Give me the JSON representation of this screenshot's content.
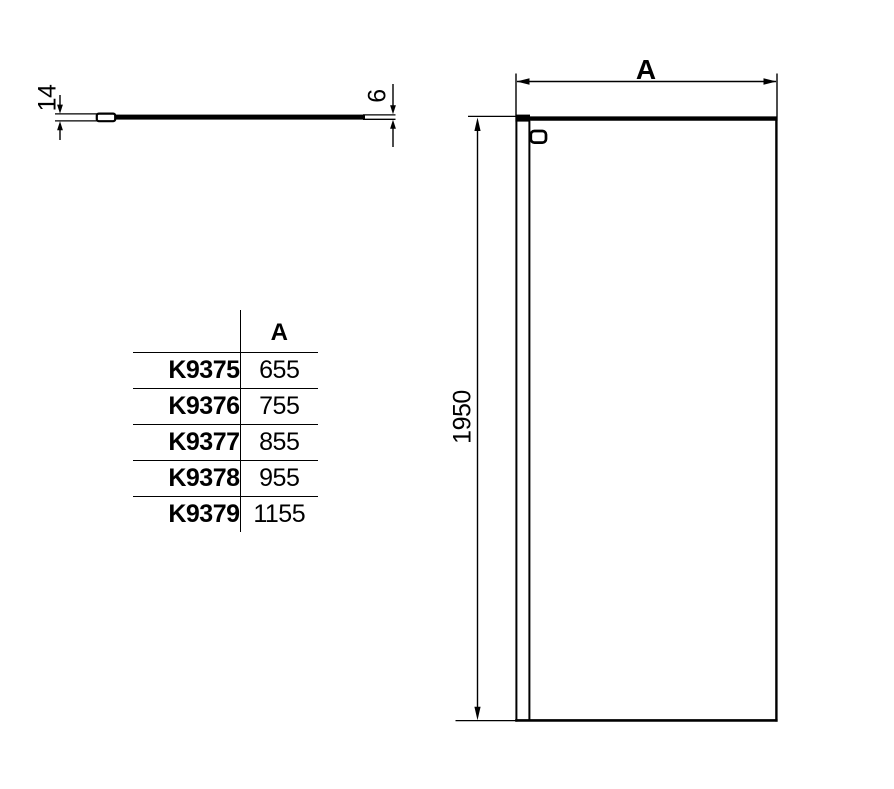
{
  "plan_view": {
    "profile_thickness": "14",
    "glass_thickness": "6"
  },
  "front_view": {
    "width_label": "A",
    "height": "1950"
  },
  "table": {
    "a_header": "A",
    "rows": [
      {
        "code": "K9375",
        "a": "655"
      },
      {
        "code": "K9376",
        "a": "755"
      },
      {
        "code": "K9377",
        "a": "855"
      },
      {
        "code": "K9378",
        "a": "955"
      },
      {
        "code": "K9379",
        "a": "1155"
      }
    ]
  },
  "colors": {
    "line": "#000000",
    "background": "#ffffff"
  }
}
